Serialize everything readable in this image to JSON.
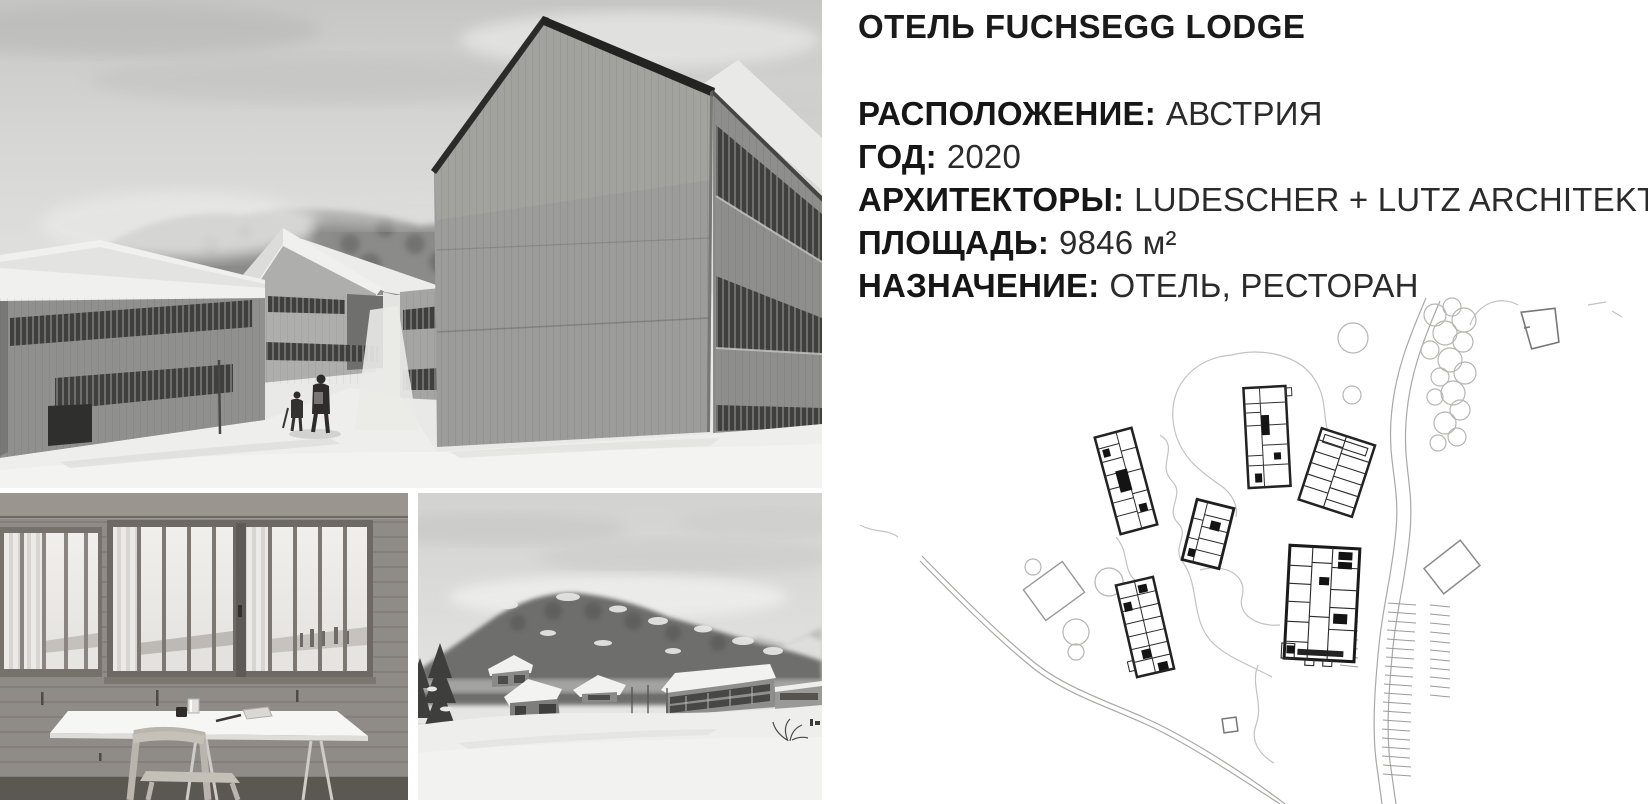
{
  "project": {
    "title": "ОТЕЛЬ FUCHSEGG LODGE",
    "details": [
      {
        "label": "РАСПОЛОЖЕНИЕ:",
        "value": "АВСТРИЯ"
      },
      {
        "label": "ГОД:",
        "value": "2020"
      },
      {
        "label": "АРХИТЕКТОРЫ:",
        "value": "LUDESCHER + LUTZ ARCHITEKTEN"
      },
      {
        "label": "ПЛОЩАДЬ:",
        "value": "9846 м²"
      },
      {
        "label": "НАЗНАЧЕНИЕ:",
        "value": "ОТЕЛЬ, РЕСТОРАН"
      }
    ]
  },
  "figures": {
    "main_photo": "winter-view-of-wooden-lodge-buildings",
    "interior_photo": "room-interior-window-table-chair",
    "landscape_photo": "snowy-valley-with-lodges",
    "site_plan": "site-plan-drawing"
  },
  "colors": {
    "text": "#1a1a1a",
    "background": "#ffffff",
    "photo_sky": "#d2d2d0",
    "wood_wall": "#90908e",
    "window_band": "#3f3f3d",
    "snow": "#eeeeec",
    "plan_line_dark": "#222222",
    "plan_line_light": "#c2c2c0"
  }
}
